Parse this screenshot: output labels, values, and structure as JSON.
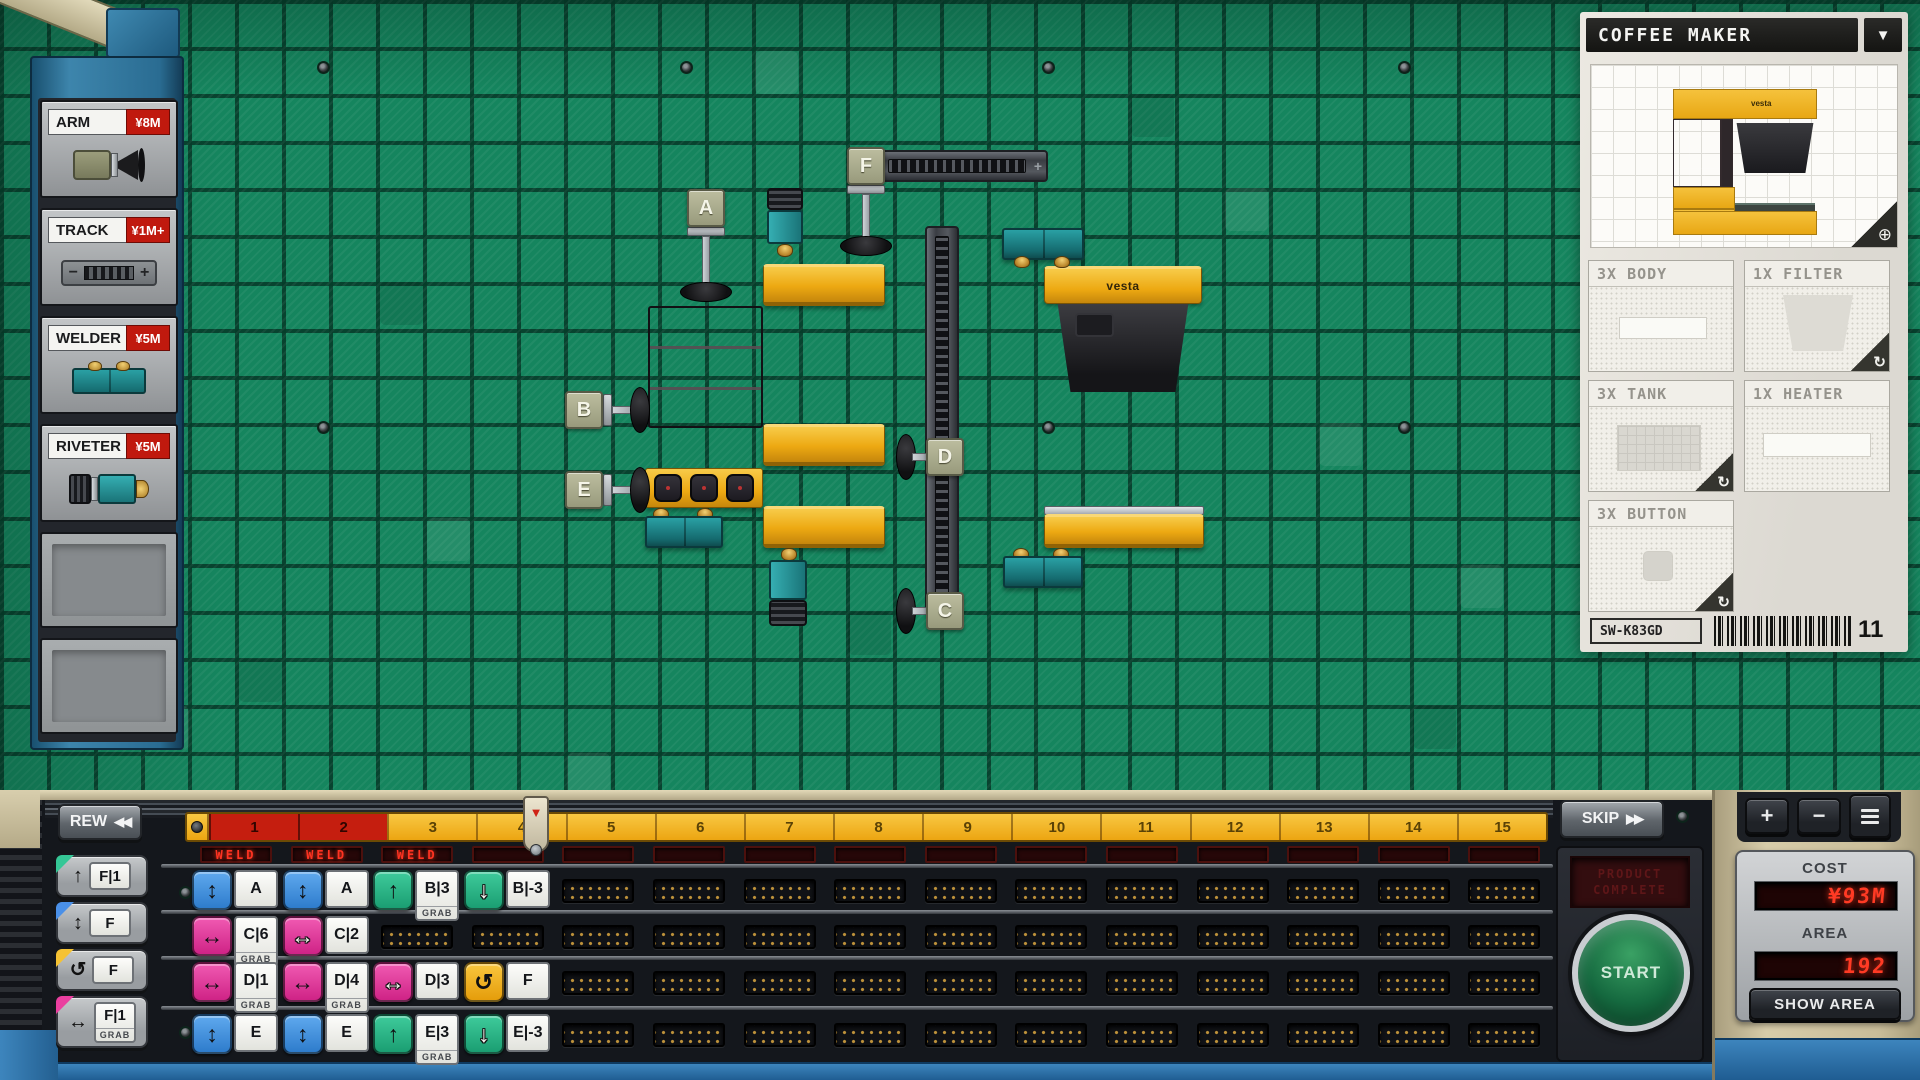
{
  "colors": {
    "accent_red": "#c0190e",
    "led_red": "#ff3322",
    "conveyor_yellow": "#eda912",
    "welder_teal": "#1f7d80",
    "cmd_blue": "#3f8fe0",
    "cmd_pink": "#e0318e",
    "cmd_green": "#2bb98a",
    "cmd_orange": "#f2b21c"
  },
  "shop": {
    "items": [
      {
        "name": "ARM",
        "price": "¥8M"
      },
      {
        "name": "TRACK",
        "price": "¥1M+"
      },
      {
        "name": "WELDER",
        "price": "¥5M"
      },
      {
        "name": "RIVETER",
        "price": "¥5M"
      }
    ]
  },
  "board": {
    "tags": [
      "A",
      "B",
      "C",
      "D",
      "E",
      "F"
    ],
    "brand": "vesta",
    "track_plus": "+"
  },
  "product": {
    "title": "COFFEE MAKER",
    "dropdown_icon": "▼",
    "magnifier_icon": "⊕",
    "rotate_icon": "↻",
    "brand": "vesta",
    "parts": [
      {
        "label": "3X BODY"
      },
      {
        "label": "1X FILTER"
      },
      {
        "label": "3X TANK"
      },
      {
        "label": "1X HEATER"
      },
      {
        "label": "3X BUTTON"
      }
    ],
    "sku": "SW-K83GD",
    "count": "11"
  },
  "palette": [
    {
      "label": "F|1",
      "icon": "↑",
      "type": "raise"
    },
    {
      "label": "F",
      "icon": "↕",
      "type": "move-vertical"
    },
    {
      "label": "F",
      "icon": "↺",
      "type": "rotate"
    },
    {
      "label": "F|1",
      "icon": "↔",
      "type": "move-horizontal",
      "grab": true
    }
  ],
  "transport": {
    "rew": "REW",
    "rew_icon": "◀◀",
    "skip": "SKIP",
    "skip_icon": "▶▶",
    "start": "START",
    "screen_line1": "PRODUCT",
    "screen_line2": "COMPLETE",
    "playhead_icon": "▼",
    "plus": "+",
    "minus": "−"
  },
  "stats": {
    "cost_label": "COST",
    "cost_value": "¥93M",
    "area_label": "AREA",
    "area_value": "192",
    "show_area": "SHOW AREA"
  },
  "timeline": {
    "grab_label": "GRAB",
    "played": 2,
    "ruler": [
      "1",
      "2",
      "3",
      "4",
      "5",
      "6",
      "7",
      "8",
      "9",
      "10",
      "11",
      "12",
      "13",
      "14",
      "15"
    ],
    "columns": [
      {
        "led": "WELD",
        "cells": [
          {
            "color": "blue",
            "icon": "↕",
            "label": "A"
          },
          {
            "color": "pink",
            "icon": "↔",
            "label": "C|6",
            "grab": true
          },
          {
            "color": "pink",
            "icon": "↔",
            "label": "D|1",
            "grab": true
          },
          {
            "color": "blue",
            "icon": "↕",
            "label": "E"
          }
        ]
      },
      {
        "led": "WELD",
        "cells": [
          {
            "color": "blue",
            "icon": "↕",
            "label": "A"
          },
          {
            "color": "pink",
            "icon": "↔",
            "label": "C|2",
            "outline": true
          },
          {
            "color": "pink",
            "icon": "↔",
            "label": "D|4",
            "grab": true
          },
          {
            "color": "blue",
            "icon": "↕",
            "label": "E"
          }
        ]
      },
      {
        "led": "WELD",
        "cells": [
          {
            "color": "green",
            "icon": "↑",
            "label": "B|3",
            "grab": true
          },
          null,
          {
            "color": "pink",
            "icon": "↔",
            "label": "D|3",
            "outline": true
          },
          {
            "color": "green",
            "icon": "↑",
            "label": "E|3",
            "grab": true
          }
        ]
      },
      {
        "led": "",
        "cells": [
          {
            "color": "green",
            "icon": "↓",
            "label": "B|-3",
            "outline": true
          },
          null,
          {
            "color": "orange",
            "icon": "↺",
            "label": "F"
          },
          {
            "color": "green",
            "icon": "↓",
            "label": "E|-3",
            "outline": true
          }
        ]
      },
      {
        "led": "",
        "cells": [
          null,
          null,
          null,
          null
        ]
      },
      {
        "led": "",
        "cells": [
          null,
          null,
          null,
          null
        ]
      },
      {
        "led": "",
        "cells": [
          null,
          null,
          null,
          null
        ]
      },
      {
        "led": "",
        "cells": [
          null,
          null,
          null,
          null
        ]
      },
      {
        "led": "",
        "cells": [
          null,
          null,
          null,
          null
        ]
      },
      {
        "led": "",
        "cells": [
          null,
          null,
          null,
          null
        ]
      },
      {
        "led": "",
        "cells": [
          null,
          null,
          null,
          null
        ]
      },
      {
        "led": "",
        "cells": [
          null,
          null,
          null,
          null
        ]
      },
      {
        "led": "",
        "cells": [
          null,
          null,
          null,
          null
        ]
      },
      {
        "led": "",
        "cells": [
          null,
          null,
          null,
          null
        ]
      },
      {
        "led": "",
        "cells": [
          null,
          null,
          null,
          null
        ]
      }
    ]
  }
}
